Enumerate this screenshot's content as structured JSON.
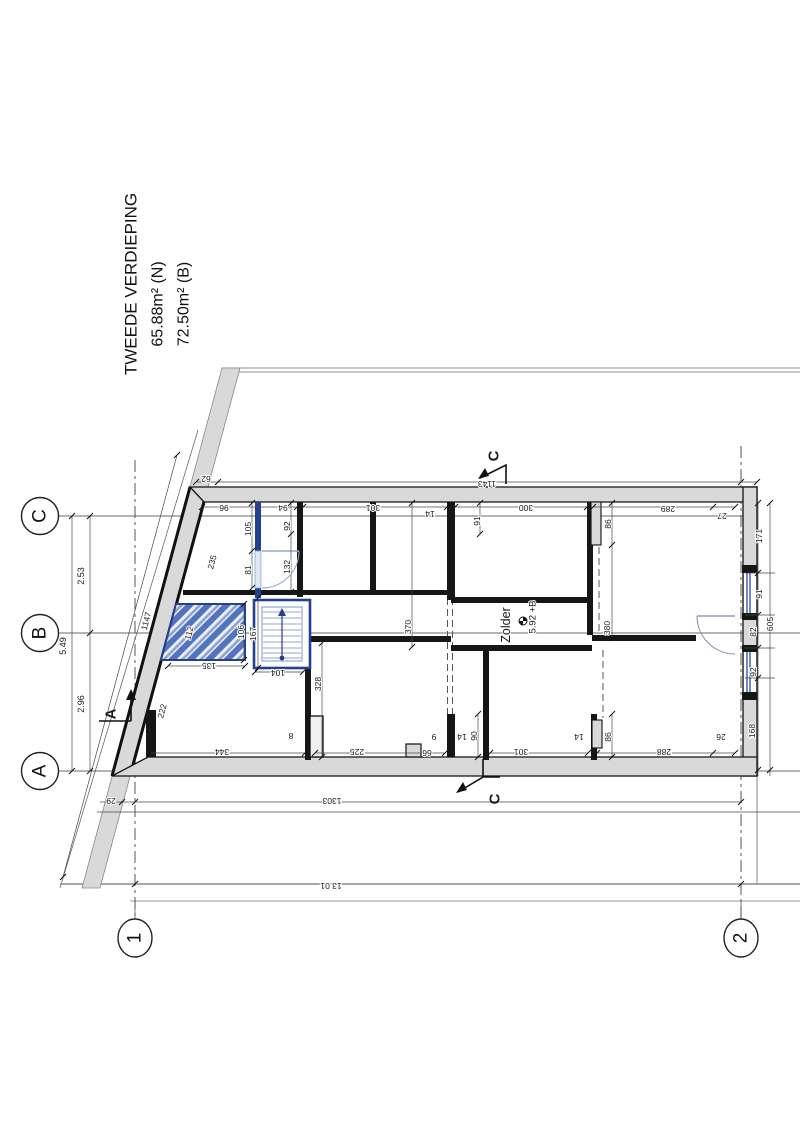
{
  "drawing": {
    "title": "TWEEDE VERDIEPING",
    "area_net": "65.88m² (N)",
    "area_gross": "72.50m² (B)",
    "room_label": "Zolder",
    "level_label": "5.92 +B"
  },
  "grid": {
    "row_labels": [
      "C",
      "B",
      "A"
    ],
    "col_labels": [
      "1",
      "2"
    ]
  },
  "section_markers": [
    "C",
    "C",
    "A"
  ],
  "colors": {
    "wall": "#161616",
    "wall_fill": "#d9d9d9",
    "blue": "#24418f",
    "blue_light": "#8fa7cd",
    "hatch_stripe": "#5273bd"
  },
  "labels": [
    {
      "t": "TWEEDE VERDIEPING",
      "x": 131,
      "y": 284,
      "r": -90,
      "s": 17,
      "cls": "title",
      "n": "plan-title"
    },
    {
      "t": "65.88m² (N)",
      "x": 158,
      "y": 304,
      "r": -90,
      "s": 16,
      "cls": "title",
      "n": "area-net-label"
    },
    {
      "t": "72.50m² (B)",
      "x": 184,
      "y": 304,
      "r": -90,
      "s": 16,
      "cls": "title",
      "n": "area-gross-label"
    },
    {
      "t": "C",
      "x": 40,
      "y": 516,
      "r": -90,
      "s": 19,
      "cls": "grid",
      "n": "grid-label-c"
    },
    {
      "t": "B",
      "x": 40,
      "y": 633,
      "r": -90,
      "s": 19,
      "cls": "grid",
      "n": "grid-label-b"
    },
    {
      "t": "A",
      "x": 40,
      "y": 771,
      "r": -90,
      "s": 19,
      "cls": "grid",
      "n": "grid-label-a"
    },
    {
      "t": "1",
      "x": 135,
      "y": 938,
      "r": -90,
      "s": 19,
      "cls": "grid",
      "n": "grid-label-1"
    },
    {
      "t": "2",
      "x": 741,
      "y": 938,
      "r": -90,
      "s": 19,
      "cls": "grid",
      "n": "grid-label-2"
    },
    {
      "t": "C",
      "x": 494,
      "y": 456,
      "r": -90,
      "s": 15,
      "cls": "sec",
      "n": "section-marker-c-top"
    },
    {
      "t": "C",
      "x": 495,
      "y": 799,
      "r": -90,
      "s": 15,
      "cls": "sec",
      "n": "section-marker-c-bottom"
    },
    {
      "t": "A",
      "x": 111,
      "y": 714,
      "r": -90,
      "s": 15,
      "cls": "sec",
      "n": "section-marker-a"
    },
    {
      "t": "Zolder",
      "x": 506,
      "y": 625,
      "r": -90,
      "s": 12.5,
      "cls": "room",
      "n": "room-label"
    },
    {
      "t": "5.92 +B",
      "x": 533,
      "y": 617,
      "r": -90,
      "s": 9.5,
      "cls": "dim",
      "n": "level-label"
    },
    {
      "t": "2.53",
      "x": 81,
      "y": 576,
      "r": -90,
      "s": 9,
      "cls": "dim",
      "n": "dim-label"
    },
    {
      "t": "5.49",
      "x": 63,
      "y": 646,
      "r": -90,
      "s": 9,
      "cls": "dim",
      "n": "dim-label"
    },
    {
      "t": "2.96",
      "x": 81,
      "y": 704,
      "r": -90,
      "s": 9,
      "cls": "dim",
      "n": "dim-label"
    },
    {
      "t": "1147",
      "x": 146,
      "y": 621,
      "r": -75,
      "s": 8.5,
      "cls": "dim",
      "n": "dim-label"
    },
    {
      "t": "235",
      "x": 212,
      "y": 562,
      "r": -75,
      "s": 8.5,
      "cls": "dim",
      "n": "dim-label"
    },
    {
      "t": "112",
      "x": 189,
      "y": 633,
      "r": -75,
      "s": 8.5,
      "cls": "dim",
      "n": "dim-label"
    },
    {
      "t": "222",
      "x": 162,
      "y": 711,
      "r": -75,
      "s": 8.5,
      "cls": "dim",
      "n": "dim-label"
    },
    {
      "t": "62",
      "x": 206,
      "y": 479,
      "r": 180,
      "s": 8.5,
      "cls": "dim",
      "n": "dim-label"
    },
    {
      "t": "1143",
      "x": 487,
      "y": 484,
      "r": 180,
      "s": 8.5,
      "cls": "dim",
      "n": "dim-label"
    },
    {
      "t": "96",
      "x": 224,
      "y": 508,
      "r": 180,
      "s": 8.5,
      "cls": "dim",
      "n": "dim-label"
    },
    {
      "t": "94",
      "x": 283,
      "y": 508,
      "r": 180,
      "s": 8.5,
      "cls": "dim",
      "n": "dim-label"
    },
    {
      "t": "301",
      "x": 373,
      "y": 508,
      "r": 180,
      "s": 8.5,
      "cls": "dim",
      "n": "dim-label"
    },
    {
      "t": "14",
      "x": 430,
      "y": 514,
      "r": 180,
      "s": 8.5,
      "cls": "dim",
      "n": "dim-label"
    },
    {
      "t": "300",
      "x": 526,
      "y": 508,
      "r": 180,
      "s": 8.5,
      "cls": "dim",
      "n": "dim-label"
    },
    {
      "t": "289",
      "x": 668,
      "y": 509,
      "r": 180,
      "s": 8.5,
      "cls": "dim",
      "n": "dim-label"
    },
    {
      "t": "27",
      "x": 722,
      "y": 516,
      "r": 180,
      "s": 8.5,
      "cls": "dim",
      "n": "dim-label"
    },
    {
      "t": "105",
      "x": 248,
      "y": 529,
      "r": -90,
      "s": 8.5,
      "cls": "dim",
      "n": "dim-label"
    },
    {
      "t": "81",
      "x": 248,
      "y": 570,
      "r": -90,
      "s": 8.5,
      "cls": "dim",
      "n": "dim-label"
    },
    {
      "t": "92",
      "x": 287,
      "y": 526,
      "r": -90,
      "s": 8.5,
      "cls": "dim",
      "n": "dim-label"
    },
    {
      "t": "132",
      "x": 287,
      "y": 567,
      "r": -90,
      "s": 8.5,
      "cls": "dim",
      "n": "dim-label"
    },
    {
      "t": "91",
      "x": 477,
      "y": 521,
      "r": -90,
      "s": 8.5,
      "cls": "dim",
      "n": "dim-label"
    },
    {
      "t": "86",
      "x": 608,
      "y": 524,
      "r": -90,
      "s": 8.5,
      "cls": "dim",
      "n": "dim-label"
    },
    {
      "t": "106",
      "x": 241,
      "y": 632,
      "r": -90,
      "s": 8.5,
      "cls": "dim",
      "n": "dim-label"
    },
    {
      "t": "167",
      "x": 253,
      "y": 634,
      "r": -90,
      "s": 8.5,
      "cls": "dim",
      "n": "dim-label"
    },
    {
      "t": "370",
      "x": 408,
      "y": 627,
      "r": -90,
      "s": 8.5,
      "cls": "dim",
      "n": "dim-label"
    },
    {
      "t": "380",
      "x": 607,
      "y": 628,
      "r": -90,
      "s": 8.5,
      "cls": "dim",
      "n": "dim-label"
    },
    {
      "t": "328",
      "x": 318,
      "y": 684,
      "r": -90,
      "s": 8.5,
      "cls": "dim",
      "n": "dim-label"
    },
    {
      "t": "171",
      "x": 759,
      "y": 536,
      "r": -90,
      "s": 8.5,
      "cls": "dim",
      "n": "dim-label"
    },
    {
      "t": "91",
      "x": 759,
      "y": 594,
      "r": -90,
      "s": 8.5,
      "cls": "dim",
      "n": "dim-label"
    },
    {
      "t": "82",
      "x": 753,
      "y": 632,
      "r": -90,
      "s": 8.5,
      "cls": "dim",
      "n": "dim-label"
    },
    {
      "t": "605",
      "x": 770,
      "y": 624,
      "r": -90,
      "s": 8.5,
      "cls": "dim",
      "n": "dim-label"
    },
    {
      "t": "92",
      "x": 753,
      "y": 672,
      "r": -90,
      "s": 8.5,
      "cls": "dim",
      "n": "dim-label"
    },
    {
      "t": "168",
      "x": 752,
      "y": 731,
      "r": -90,
      "s": 8.5,
      "cls": "dim",
      "n": "dim-label"
    },
    {
      "t": "90",
      "x": 474,
      "y": 736,
      "r": -90,
      "s": 8.5,
      "cls": "dim",
      "n": "dim-label"
    },
    {
      "t": "86",
      "x": 608,
      "y": 737,
      "r": -90,
      "s": 8.5,
      "cls": "dim",
      "n": "dim-label"
    },
    {
      "t": "135",
      "x": 209,
      "y": 666,
      "r": 180,
      "s": 8.5,
      "cls": "dim",
      "n": "dim-label"
    },
    {
      "t": "104",
      "x": 278,
      "y": 673,
      "r": 180,
      "s": 8.5,
      "cls": "dim",
      "n": "dim-label"
    },
    {
      "t": "344",
      "x": 222,
      "y": 752,
      "r": 180,
      "s": 8.5,
      "cls": "dim",
      "n": "dim-label"
    },
    {
      "t": "8",
      "x": 291,
      "y": 736,
      "r": 180,
      "s": 8.5,
      "cls": "dim",
      "n": "dim-label"
    },
    {
      "t": "225",
      "x": 357,
      "y": 752,
      "r": 180,
      "s": 8.5,
      "cls": "dim",
      "n": "dim-label"
    },
    {
      "t": "66",
      "x": 427,
      "y": 753,
      "r": 180,
      "s": 8.5,
      "cls": "dim",
      "n": "dim-label"
    },
    {
      "t": "9",
      "x": 434,
      "y": 737,
      "r": 180,
      "s": 8.5,
      "cls": "dim",
      "n": "dim-label"
    },
    {
      "t": "14",
      "x": 462,
      "y": 737,
      "r": 180,
      "s": 8.5,
      "cls": "dim",
      "n": "dim-label"
    },
    {
      "t": "301",
      "x": 521,
      "y": 752,
      "r": 180,
      "s": 8.5,
      "cls": "dim",
      "n": "dim-label"
    },
    {
      "t": "14",
      "x": 579,
      "y": 737,
      "r": 180,
      "s": 8.5,
      "cls": "dim",
      "n": "dim-label"
    },
    {
      "t": "288",
      "x": 664,
      "y": 752,
      "r": 180,
      "s": 8.5,
      "cls": "dim",
      "n": "dim-label"
    },
    {
      "t": "26",
      "x": 721,
      "y": 737,
      "r": 180,
      "s": 8.5,
      "cls": "dim",
      "n": "dim-label"
    },
    {
      "t": "29",
      "x": 111,
      "y": 801,
      "r": 180,
      "s": 8.5,
      "cls": "dim",
      "n": "dim-label"
    },
    {
      "t": "1303",
      "x": 332,
      "y": 801,
      "r": 180,
      "s": 8.5,
      "cls": "dim",
      "n": "dim-label"
    },
    {
      "t": "13.01",
      "x": 331,
      "y": 886,
      "r": 180,
      "s": 8.5,
      "cls": "dim",
      "n": "dim-label"
    }
  ]
}
